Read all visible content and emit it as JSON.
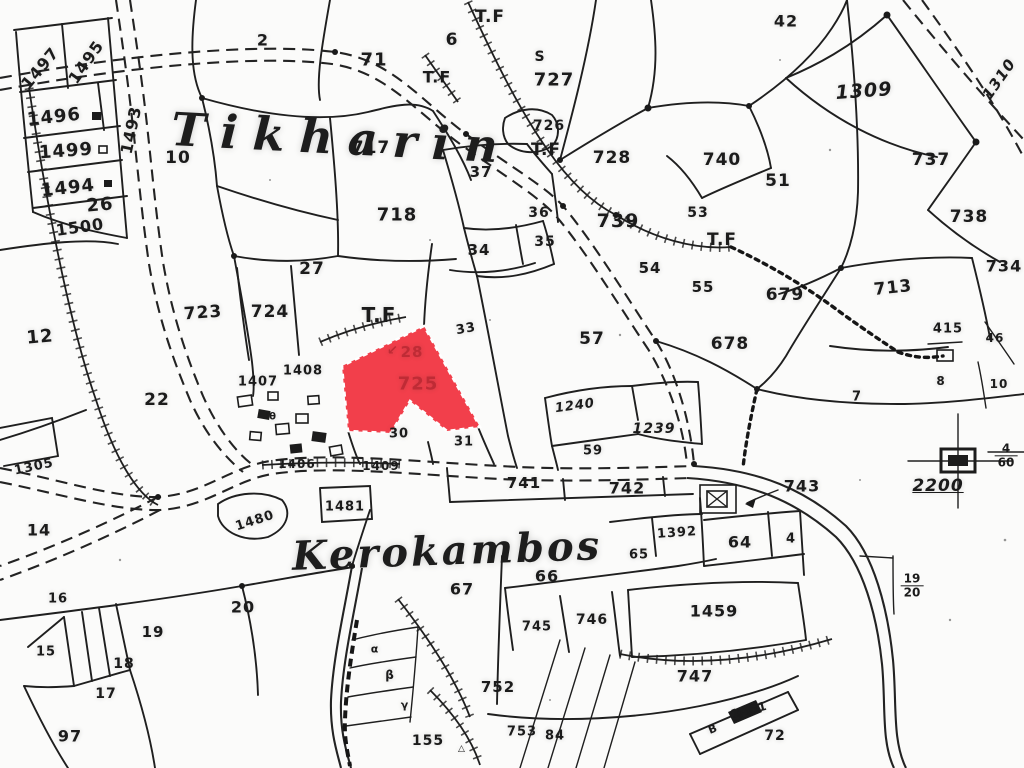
{
  "map": {
    "place_names": [
      {
        "text": "Tikharin"
      },
      {
        "text": "Kerokambos"
      }
    ],
    "highlight": {
      "parcel_number": "725",
      "annotation": "28",
      "marker": "↙",
      "fill": "#f23f4b",
      "text_color": "#bf2b35",
      "outline": "#ffffff"
    },
    "benchmark": {
      "value": "2200"
    },
    "colors": {
      "ink": "#1f1f1f",
      "paper": "#fbfbfa"
    },
    "fractions": [
      {
        "top": "4",
        "bottom": "60",
        "x": 1006,
        "y": 456
      },
      {
        "top": "19",
        "bottom": "20",
        "x": 912,
        "y": 586
      }
    ],
    "labels": [
      {
        "text": "1497",
        "x": 40,
        "y": 68,
        "s": 16,
        "r": -50
      },
      {
        "text": "1495",
        "x": 86,
        "y": 62,
        "s": 16,
        "r": -55
      },
      {
        "text": "1496",
        "x": 54,
        "y": 117,
        "s": 18,
        "r": -6
      },
      {
        "text": "1493",
        "x": 131,
        "y": 130,
        "s": 16,
        "r": -78
      },
      {
        "text": "1499",
        "x": 66,
        "y": 151,
        "s": 18,
        "r": -4
      },
      {
        "text": "1494",
        "x": 68,
        "y": 188,
        "s": 18,
        "r": -6
      },
      {
        "text": "1500",
        "x": 80,
        "y": 227,
        "s": 16,
        "r": -8
      },
      {
        "text": "10",
        "x": 178,
        "y": 158,
        "s": 17
      },
      {
        "text": "26",
        "x": 100,
        "y": 205,
        "s": 18,
        "r": -5
      },
      {
        "text": "12",
        "x": 40,
        "y": 337,
        "s": 18,
        "r": -5
      },
      {
        "text": "22",
        "x": 157,
        "y": 400,
        "s": 17
      },
      {
        "text": "1305",
        "x": 34,
        "y": 467,
        "s": 13,
        "r": -12
      },
      {
        "text": "14",
        "x": 39,
        "y": 530,
        "s": 16
      },
      {
        "text": "16",
        "x": 58,
        "y": 599,
        "s": 13
      },
      {
        "text": "15",
        "x": 46,
        "y": 652,
        "s": 13
      },
      {
        "text": "19",
        "x": 153,
        "y": 632,
        "s": 15
      },
      {
        "text": "18",
        "x": 124,
        "y": 664,
        "s": 14
      },
      {
        "text": "17",
        "x": 106,
        "y": 694,
        "s": 14
      },
      {
        "text": "97",
        "x": 70,
        "y": 736,
        "s": 16
      },
      {
        "text": "20",
        "x": 243,
        "y": 607,
        "s": 16
      },
      {
        "text": "2",
        "x": 263,
        "y": 40,
        "s": 16
      },
      {
        "text": "71",
        "x": 374,
        "y": 60,
        "s": 18
      },
      {
        "text": "6",
        "x": 452,
        "y": 40,
        "s": 17
      },
      {
        "text": "T.F",
        "x": 490,
        "y": 17,
        "s": 17
      },
      {
        "text": "T.F",
        "x": 437,
        "y": 77,
        "s": 16
      },
      {
        "text": "S",
        "x": 540,
        "y": 57,
        "s": 14
      },
      {
        "text": "727",
        "x": 554,
        "y": 80,
        "s": 18
      },
      {
        "text": "726",
        "x": 549,
        "y": 126,
        "s": 14
      },
      {
        "text": "T.F",
        "x": 546,
        "y": 150,
        "s": 17
      },
      {
        "text": "717",
        "x": 371,
        "y": 148,
        "s": 17
      },
      {
        "text": "37",
        "x": 481,
        "y": 172,
        "s": 15
      },
      {
        "text": "718",
        "x": 397,
        "y": 215,
        "s": 18
      },
      {
        "text": "36",
        "x": 539,
        "y": 213,
        "s": 14
      },
      {
        "text": "34",
        "x": 479,
        "y": 250,
        "s": 15
      },
      {
        "text": "35",
        "x": 545,
        "y": 242,
        "s": 14
      },
      {
        "text": "728",
        "x": 612,
        "y": 158,
        "s": 17
      },
      {
        "text": "739",
        "x": 618,
        "y": 221,
        "s": 19
      },
      {
        "text": "740",
        "x": 722,
        "y": 160,
        "s": 17
      },
      {
        "text": "51",
        "x": 778,
        "y": 181,
        "s": 17
      },
      {
        "text": "53",
        "x": 698,
        "y": 213,
        "s": 14
      },
      {
        "text": "T.F",
        "x": 722,
        "y": 240,
        "s": 17
      },
      {
        "text": "54",
        "x": 650,
        "y": 268,
        "s": 15
      },
      {
        "text": "55",
        "x": 703,
        "y": 287,
        "s": 15
      },
      {
        "text": "42",
        "x": 786,
        "y": 21,
        "s": 16
      },
      {
        "text": "1309",
        "x": 864,
        "y": 91,
        "s": 19,
        "r": -4,
        "i": 1
      },
      {
        "text": "1310",
        "x": 999,
        "y": 79,
        "s": 15,
        "r": -55,
        "i": 1
      },
      {
        "text": "737",
        "x": 931,
        "y": 160,
        "s": 17
      },
      {
        "text": "738",
        "x": 969,
        "y": 217,
        "s": 17
      },
      {
        "text": "734",
        "x": 1004,
        "y": 266,
        "s": 16
      },
      {
        "text": "713",
        "x": 893,
        "y": 288,
        "s": 17,
        "r": -6
      },
      {
        "text": "415",
        "x": 948,
        "y": 329,
        "s": 13
      },
      {
        "text": "46",
        "x": 995,
        "y": 338,
        "s": 12
      },
      {
        "text": "8",
        "x": 941,
        "y": 381,
        "s": 12
      },
      {
        "text": "10",
        "x": 999,
        "y": 384,
        "s": 12
      },
      {
        "text": "679",
        "x": 785,
        "y": 295,
        "s": 17
      },
      {
        "text": "678",
        "x": 730,
        "y": 344,
        "s": 17
      },
      {
        "text": "7",
        "x": 857,
        "y": 397,
        "s": 13
      },
      {
        "text": "27",
        "x": 312,
        "y": 269,
        "s": 17
      },
      {
        "text": "723",
        "x": 203,
        "y": 313,
        "s": 17,
        "r": -4
      },
      {
        "text": "724",
        "x": 270,
        "y": 312,
        "s": 17
      },
      {
        "text": "T.F",
        "x": 379,
        "y": 315,
        "s": 20
      },
      {
        "text": "33",
        "x": 466,
        "y": 329,
        "s": 13,
        "r": -10
      },
      {
        "text": "57",
        "x": 592,
        "y": 339,
        "s": 17
      },
      {
        "text": "1407",
        "x": 258,
        "y": 382,
        "s": 13
      },
      {
        "text": "1408",
        "x": 303,
        "y": 371,
        "s": 13
      },
      {
        "text": "30",
        "x": 399,
        "y": 434,
        "s": 13
      },
      {
        "text": "31",
        "x": 464,
        "y": 442,
        "s": 13
      },
      {
        "text": "1240",
        "x": 575,
        "y": 406,
        "s": 13,
        "r": -8,
        "i": 1
      },
      {
        "text": "1239",
        "x": 654,
        "y": 429,
        "s": 14,
        "i": 1
      },
      {
        "text": "59",
        "x": 593,
        "y": 451,
        "s": 13
      },
      {
        "text": "1406",
        "x": 297,
        "y": 464,
        "s": 12
      },
      {
        "text": "1409",
        "x": 381,
        "y": 466,
        "s": 12
      },
      {
        "text": "741",
        "x": 524,
        "y": 483,
        "s": 15
      },
      {
        "text": "742",
        "x": 627,
        "y": 488,
        "s": 16
      },
      {
        "text": "743",
        "x": 802,
        "y": 486,
        "s": 16
      },
      {
        "text": "1480",
        "x": 255,
        "y": 521,
        "s": 13,
        "r": -18
      },
      {
        "text": "1481",
        "x": 345,
        "y": 507,
        "s": 13
      },
      {
        "text": "1392",
        "x": 677,
        "y": 533,
        "s": 13,
        "r": -4
      },
      {
        "text": "64",
        "x": 740,
        "y": 542,
        "s": 16
      },
      {
        "text": "4",
        "x": 791,
        "y": 539,
        "s": 13
      },
      {
        "text": "65",
        "x": 639,
        "y": 555,
        "s": 13
      },
      {
        "text": "66",
        "x": 547,
        "y": 576,
        "s": 16
      },
      {
        "text": "67",
        "x": 462,
        "y": 589,
        "s": 16
      },
      {
        "text": "746",
        "x": 592,
        "y": 620,
        "s": 14
      },
      {
        "text": "745",
        "x": 537,
        "y": 627,
        "s": 13
      },
      {
        "text": "1459",
        "x": 714,
        "y": 611,
        "s": 16
      },
      {
        "text": "747",
        "x": 695,
        "y": 676,
        "s": 16
      },
      {
        "text": "752",
        "x": 498,
        "y": 687,
        "s": 15
      },
      {
        "text": "753",
        "x": 522,
        "y": 732,
        "s": 13
      },
      {
        "text": "84",
        "x": 555,
        "y": 736,
        "s": 13
      },
      {
        "text": "155",
        "x": 428,
        "y": 741,
        "s": 14
      },
      {
        "text": "△",
        "x": 462,
        "y": 749,
        "s": 9
      },
      {
        "text": "72",
        "x": 775,
        "y": 736,
        "s": 14
      },
      {
        "text": "1461",
        "x": 749,
        "y": 710,
        "s": 12,
        "r": -14
      },
      {
        "text": "B",
        "x": 713,
        "y": 729,
        "s": 11,
        "r": -22
      },
      {
        "text": "α",
        "x": 375,
        "y": 649,
        "s": 11
      },
      {
        "text": "β",
        "x": 390,
        "y": 675,
        "s": 12
      },
      {
        "text": "γ",
        "x": 405,
        "y": 705,
        "s": 11
      },
      {
        "text": "θ",
        "x": 273,
        "y": 417,
        "s": 10
      },
      {
        "text": "2200",
        "x": 938,
        "y": 486,
        "s": 17,
        "i": 1,
        "u": 1
      },
      {
        "text": "↙",
        "x": 393,
        "y": 351,
        "s": 13,
        "c": 1
      },
      {
        "text": "28",
        "x": 412,
        "y": 352,
        "s": 15,
        "c": 1
      },
      {
        "text": "725",
        "x": 418,
        "y": 384,
        "s": 18,
        "c": 1
      }
    ]
  }
}
